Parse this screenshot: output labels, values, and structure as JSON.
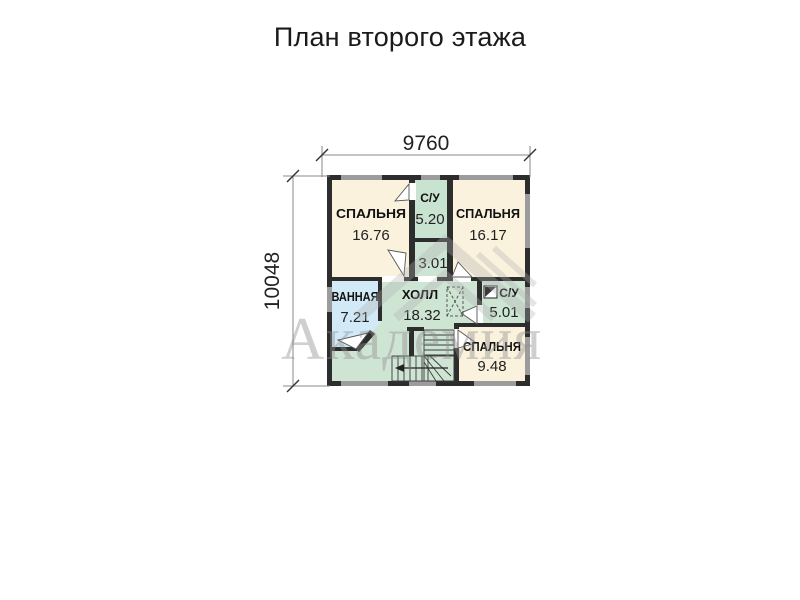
{
  "title": "План второго этажа",
  "dimensions": {
    "width_label": "9760",
    "height_label": "10048"
  },
  "watermark": {
    "text": "Академия"
  },
  "rooms": [
    {
      "id": "bedroom-1",
      "name": "СПАЛЬНЯ",
      "area": "16.76",
      "color": "#faf2dd"
    },
    {
      "id": "wc-top",
      "name": "С/У",
      "area": "5.20",
      "color": "#c9e3d1"
    },
    {
      "id": "bedroom-2",
      "name": "СПАЛЬНЯ",
      "area": "16.17",
      "color": "#faf2dd"
    },
    {
      "id": "closet",
      "name": "",
      "area": "3.01",
      "color": "#cde4d3"
    },
    {
      "id": "bathroom",
      "name": "ВАННАЯ",
      "area": "7.21",
      "color": "#d2e9f7"
    },
    {
      "id": "hall",
      "name": "ХОЛЛ",
      "area": "18.32",
      "color": "#cfe5d4"
    },
    {
      "id": "wc-right",
      "name": "С/У",
      "area": "5.01",
      "color": "#cfe5d4"
    },
    {
      "id": "bedroom-3",
      "name": "СПАЛЬНЯ",
      "area": "9.48",
      "color": "#faf2dd"
    }
  ],
  "icons": {
    "vent": "vent-shaft-icon",
    "stairs": "stairs-down-arrow"
  },
  "colors": {
    "wall": "#2d2d2d",
    "window": "#9c9c9c",
    "cream": "#faf2dd",
    "green": "#cfe5d4",
    "blue": "#d2e9f7",
    "dim_line": "#888888"
  }
}
